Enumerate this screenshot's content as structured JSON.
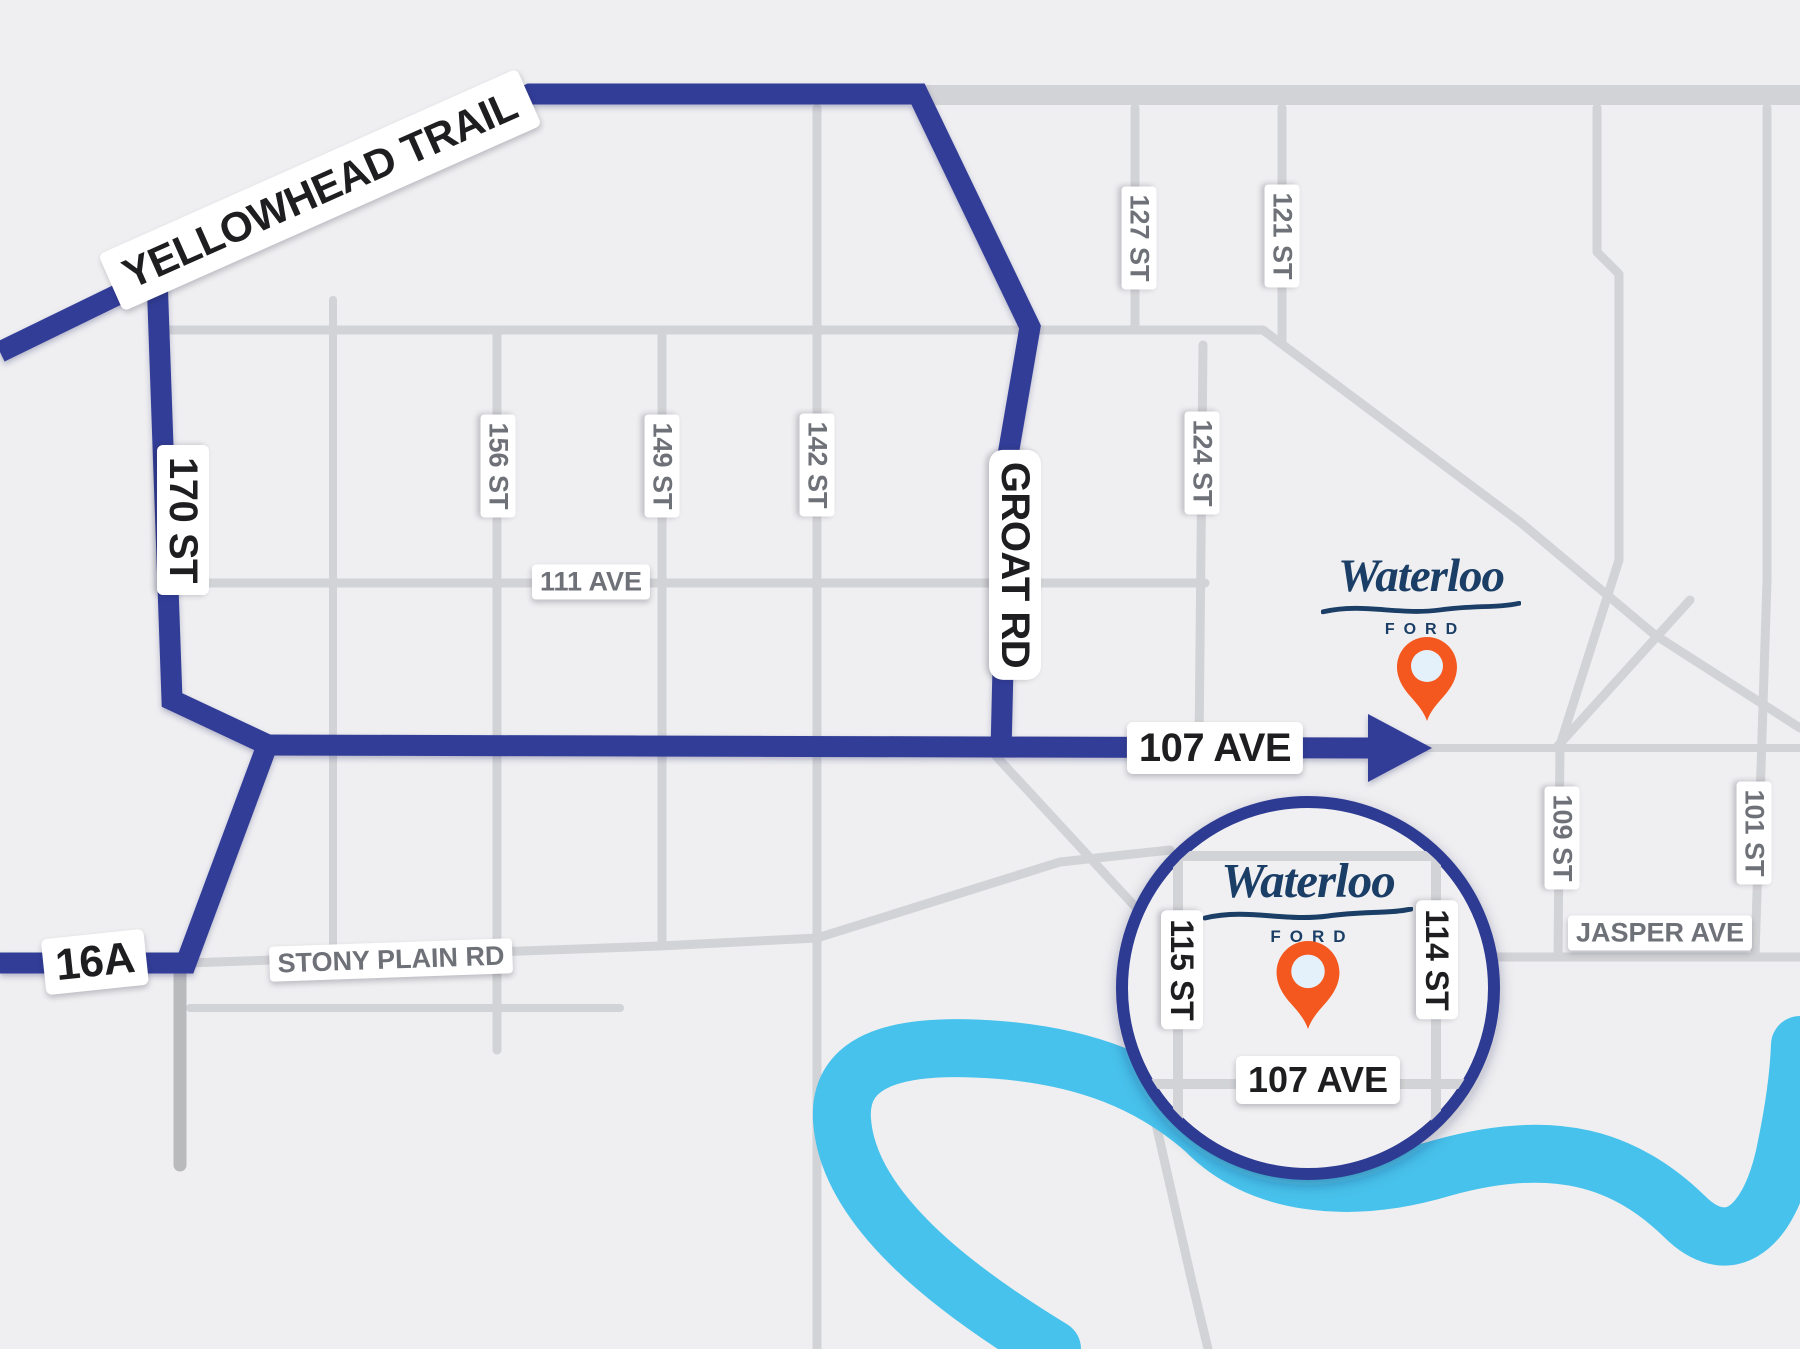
{
  "highways": {
    "yellowhead": "YELLOWHEAD TRAIL",
    "st_170": "170 ST",
    "groat": "GROAT RD",
    "ave_107": "107 AVE",
    "hwy_16a": "16A"
  },
  "streets": {
    "st_156": "156 ST",
    "st_149": "149 ST",
    "st_142": "142 ST",
    "st_127": "127 ST",
    "st_124": "124 ST",
    "st_121": "121 ST",
    "ave_111": "111 AVE",
    "stony_plain": "STONY PLAIN RD",
    "jasper": "JASPER AVE",
    "st_109": "109 ST",
    "st_101": "101 ST"
  },
  "dealership": {
    "brand": "Waterloo",
    "sub_brand": "FORD"
  },
  "inset": {
    "st_115": "115 ST",
    "st_114": "114 ST",
    "ave_107": "107 AVE"
  },
  "colors": {
    "background": "#efeff1",
    "route_blue": "#333e98",
    "river_blue": "#47c2ec",
    "pin_orange": "#f4581f",
    "pin_center": "#e4f1fa",
    "road_gray": "#d2d3d6",
    "street_label_gray": "#6e7177",
    "label_black": "#1e1e20",
    "logo_navy": "#1b3e66"
  }
}
